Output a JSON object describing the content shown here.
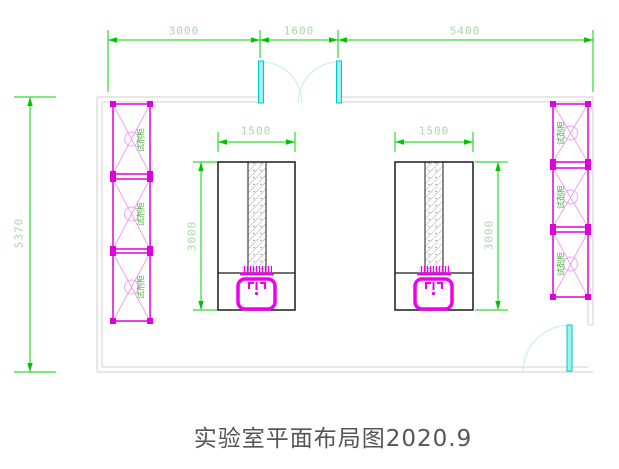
{
  "drawing": {
    "title": "实验室平面布局图2020.9",
    "dimensions": {
      "top_segments": [
        "3000",
        "1600",
        "5400"
      ],
      "room_height": "5370",
      "bench_width": "1500",
      "bench_depth": "3000"
    },
    "cabinet_label": "试剂柜",
    "counts": {
      "left_cabinets": 3,
      "right_cabinets": 3,
      "workbenches": 2,
      "sinks": 2,
      "top_double_doors": 1,
      "side_single_doors": 1
    },
    "colors": {
      "dimension_line": "#00d400",
      "dimension_text": "#a9d7a9",
      "wall": "#cfcfcf",
      "cabinet_outline": "#dd00dd",
      "cabinet_brace": "#f2a0f2",
      "cabinet_text": "#3fae3f",
      "door_leaf": "#00dede",
      "door_arc": "#c2eded",
      "bench_outline": "#1a1a1a",
      "sink": "#ee00ee",
      "title_text": "#555555"
    }
  }
}
